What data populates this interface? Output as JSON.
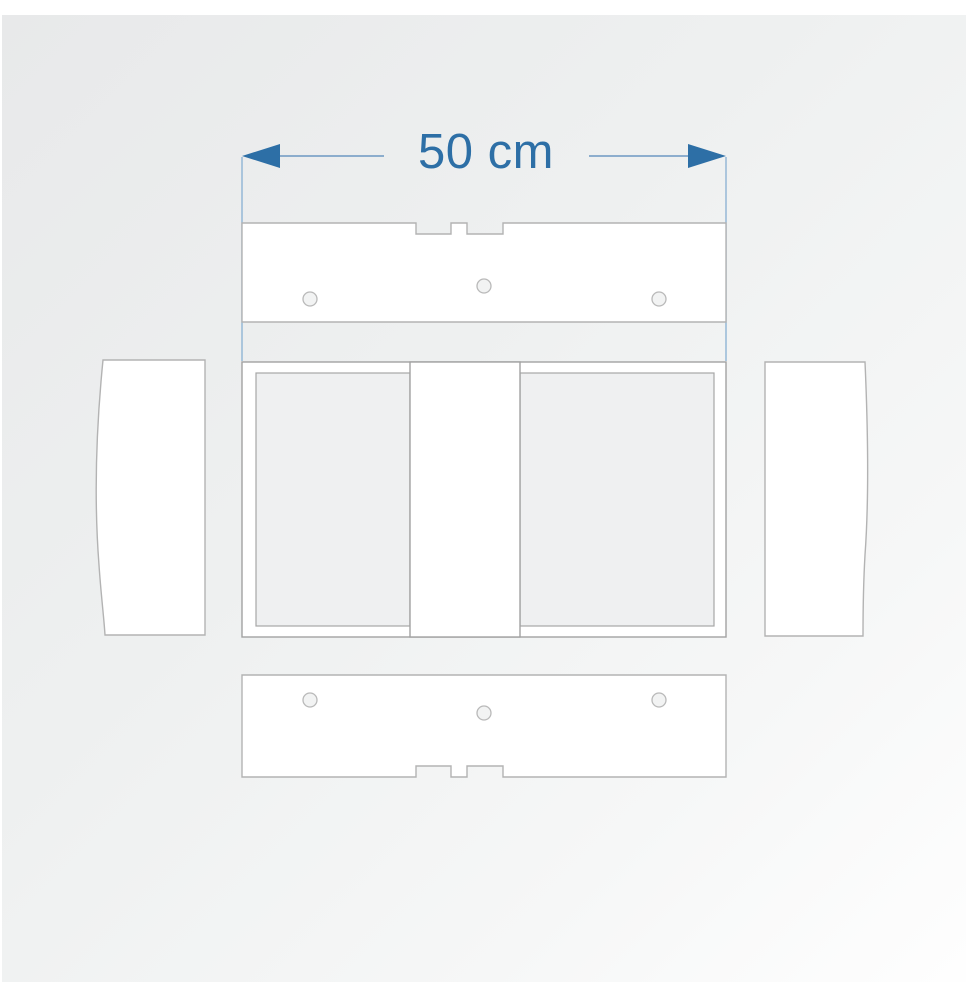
{
  "diagram": {
    "dimension_label": "50 cm"
  },
  "colors": {
    "accent_blue": "#2d6fa6",
    "dimension_line_blue": "#6d98c2",
    "extension_line_blue": "#8fb4d4",
    "panel_outline_gray": "#b3b3b3",
    "frame_outline_gray": "#a2a2a2",
    "panel_fill": "#ffffff",
    "hole_fill": "#f2f3f3",
    "background_top_left": "#e8e9ea",
    "background_bottom_right": "#fefefe"
  }
}
